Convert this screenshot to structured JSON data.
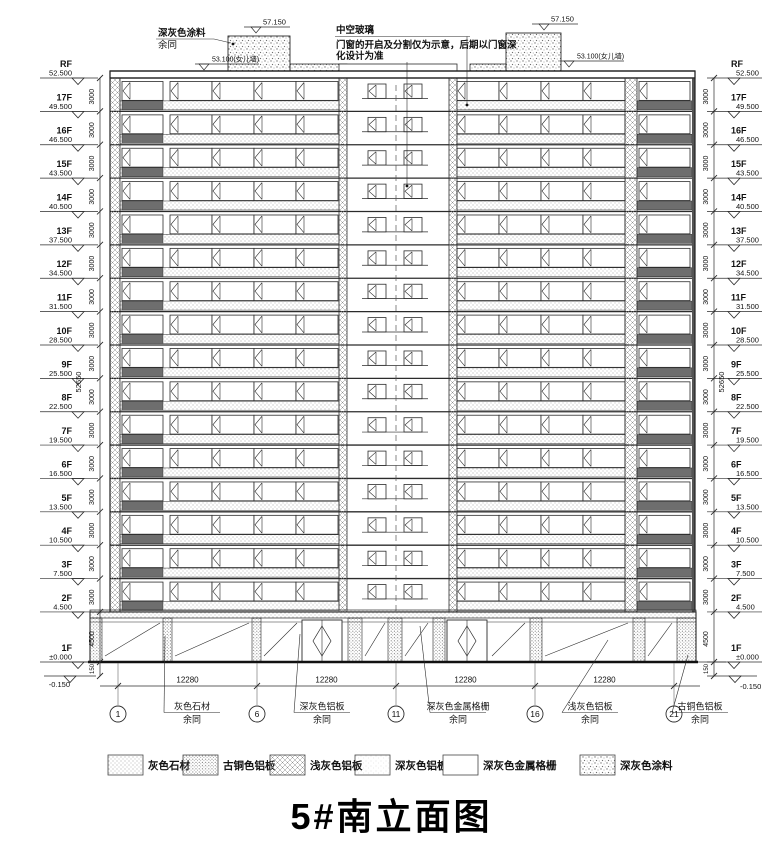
{
  "title": "5#南立面图",
  "notes": {
    "top_left": {
      "line1": "深灰色涂料",
      "line2": "余同"
    },
    "top_center": {
      "line1": "中空玻璃",
      "line2": "门窗的开启及分割仅为示意，后期以门窗深",
      "line3": "化设计为准"
    },
    "tower_elevation": "57.150",
    "parapet_elevation": "53.100(女儿墙)"
  },
  "levels": [
    {
      "label": "RF",
      "elevation": "52.500",
      "m": 52.5
    },
    {
      "label": "17F",
      "elevation": "49.500",
      "m": 49.5
    },
    {
      "label": "16F",
      "elevation": "46.500",
      "m": 46.5
    },
    {
      "label": "15F",
      "elevation": "43.500",
      "m": 43.5
    },
    {
      "label": "14F",
      "elevation": "40.500",
      "m": 40.5
    },
    {
      "label": "13F",
      "elevation": "37.500",
      "m": 37.5
    },
    {
      "label": "12F",
      "elevation": "34.500",
      "m": 34.5
    },
    {
      "label": "11F",
      "elevation": "31.500",
      "m": 31.5
    },
    {
      "label": "10F",
      "elevation": "28.500",
      "m": 28.5
    },
    {
      "label": "9F",
      "elevation": "25.500",
      "m": 25.5
    },
    {
      "label": "8F",
      "elevation": "22.500",
      "m": 22.5
    },
    {
      "label": "7F",
      "elevation": "19.500",
      "m": 19.5
    },
    {
      "label": "6F",
      "elevation": "16.500",
      "m": 16.5
    },
    {
      "label": "5F",
      "elevation": "13.500",
      "m": 13.5
    },
    {
      "label": "4F",
      "elevation": "10.500",
      "m": 10.5
    },
    {
      "label": "3F",
      "elevation": "7.500",
      "m": 7.5
    },
    {
      "label": "2F",
      "elevation": "4.500",
      "m": 4.5
    },
    {
      "label": "1F",
      "elevation": "±0.000",
      "m": 0
    }
  ],
  "below_grade_elevation": "-0.150",
  "dims": {
    "storey": "3000",
    "ground": "4500",
    "base": "150",
    "total": "52650",
    "bay": "12280"
  },
  "axes": [
    "1",
    "6",
    "11",
    "16",
    "21"
  ],
  "material_notes": [
    {
      "line1": "灰色石材",
      "line2": "余同"
    },
    {
      "line1": "深灰色铝板",
      "line2": "余同"
    },
    {
      "line1": "深灰色金属格栅",
      "line2": "余同"
    },
    {
      "line1": "浅灰色铝板",
      "line2": "余同"
    },
    {
      "line1": "古铜色铝板",
      "line2": "余同"
    }
  ],
  "legend": [
    {
      "label": "灰色石材",
      "pattern": "stone"
    },
    {
      "label": "古铜色铝板",
      "pattern": "bronze"
    },
    {
      "label": "浅灰色铝板",
      "pattern": "cross"
    },
    {
      "label": "深灰色铝板",
      "pattern": "fine"
    },
    {
      "label": "深灰色金属格栅",
      "pattern": "grille"
    },
    {
      "label": "深灰色涂料",
      "pattern": "paint"
    }
  ],
  "colors": {
    "line": "#2b2b2b",
    "dark_panel": "#6e6e6e",
    "paper": "#ffffff"
  }
}
